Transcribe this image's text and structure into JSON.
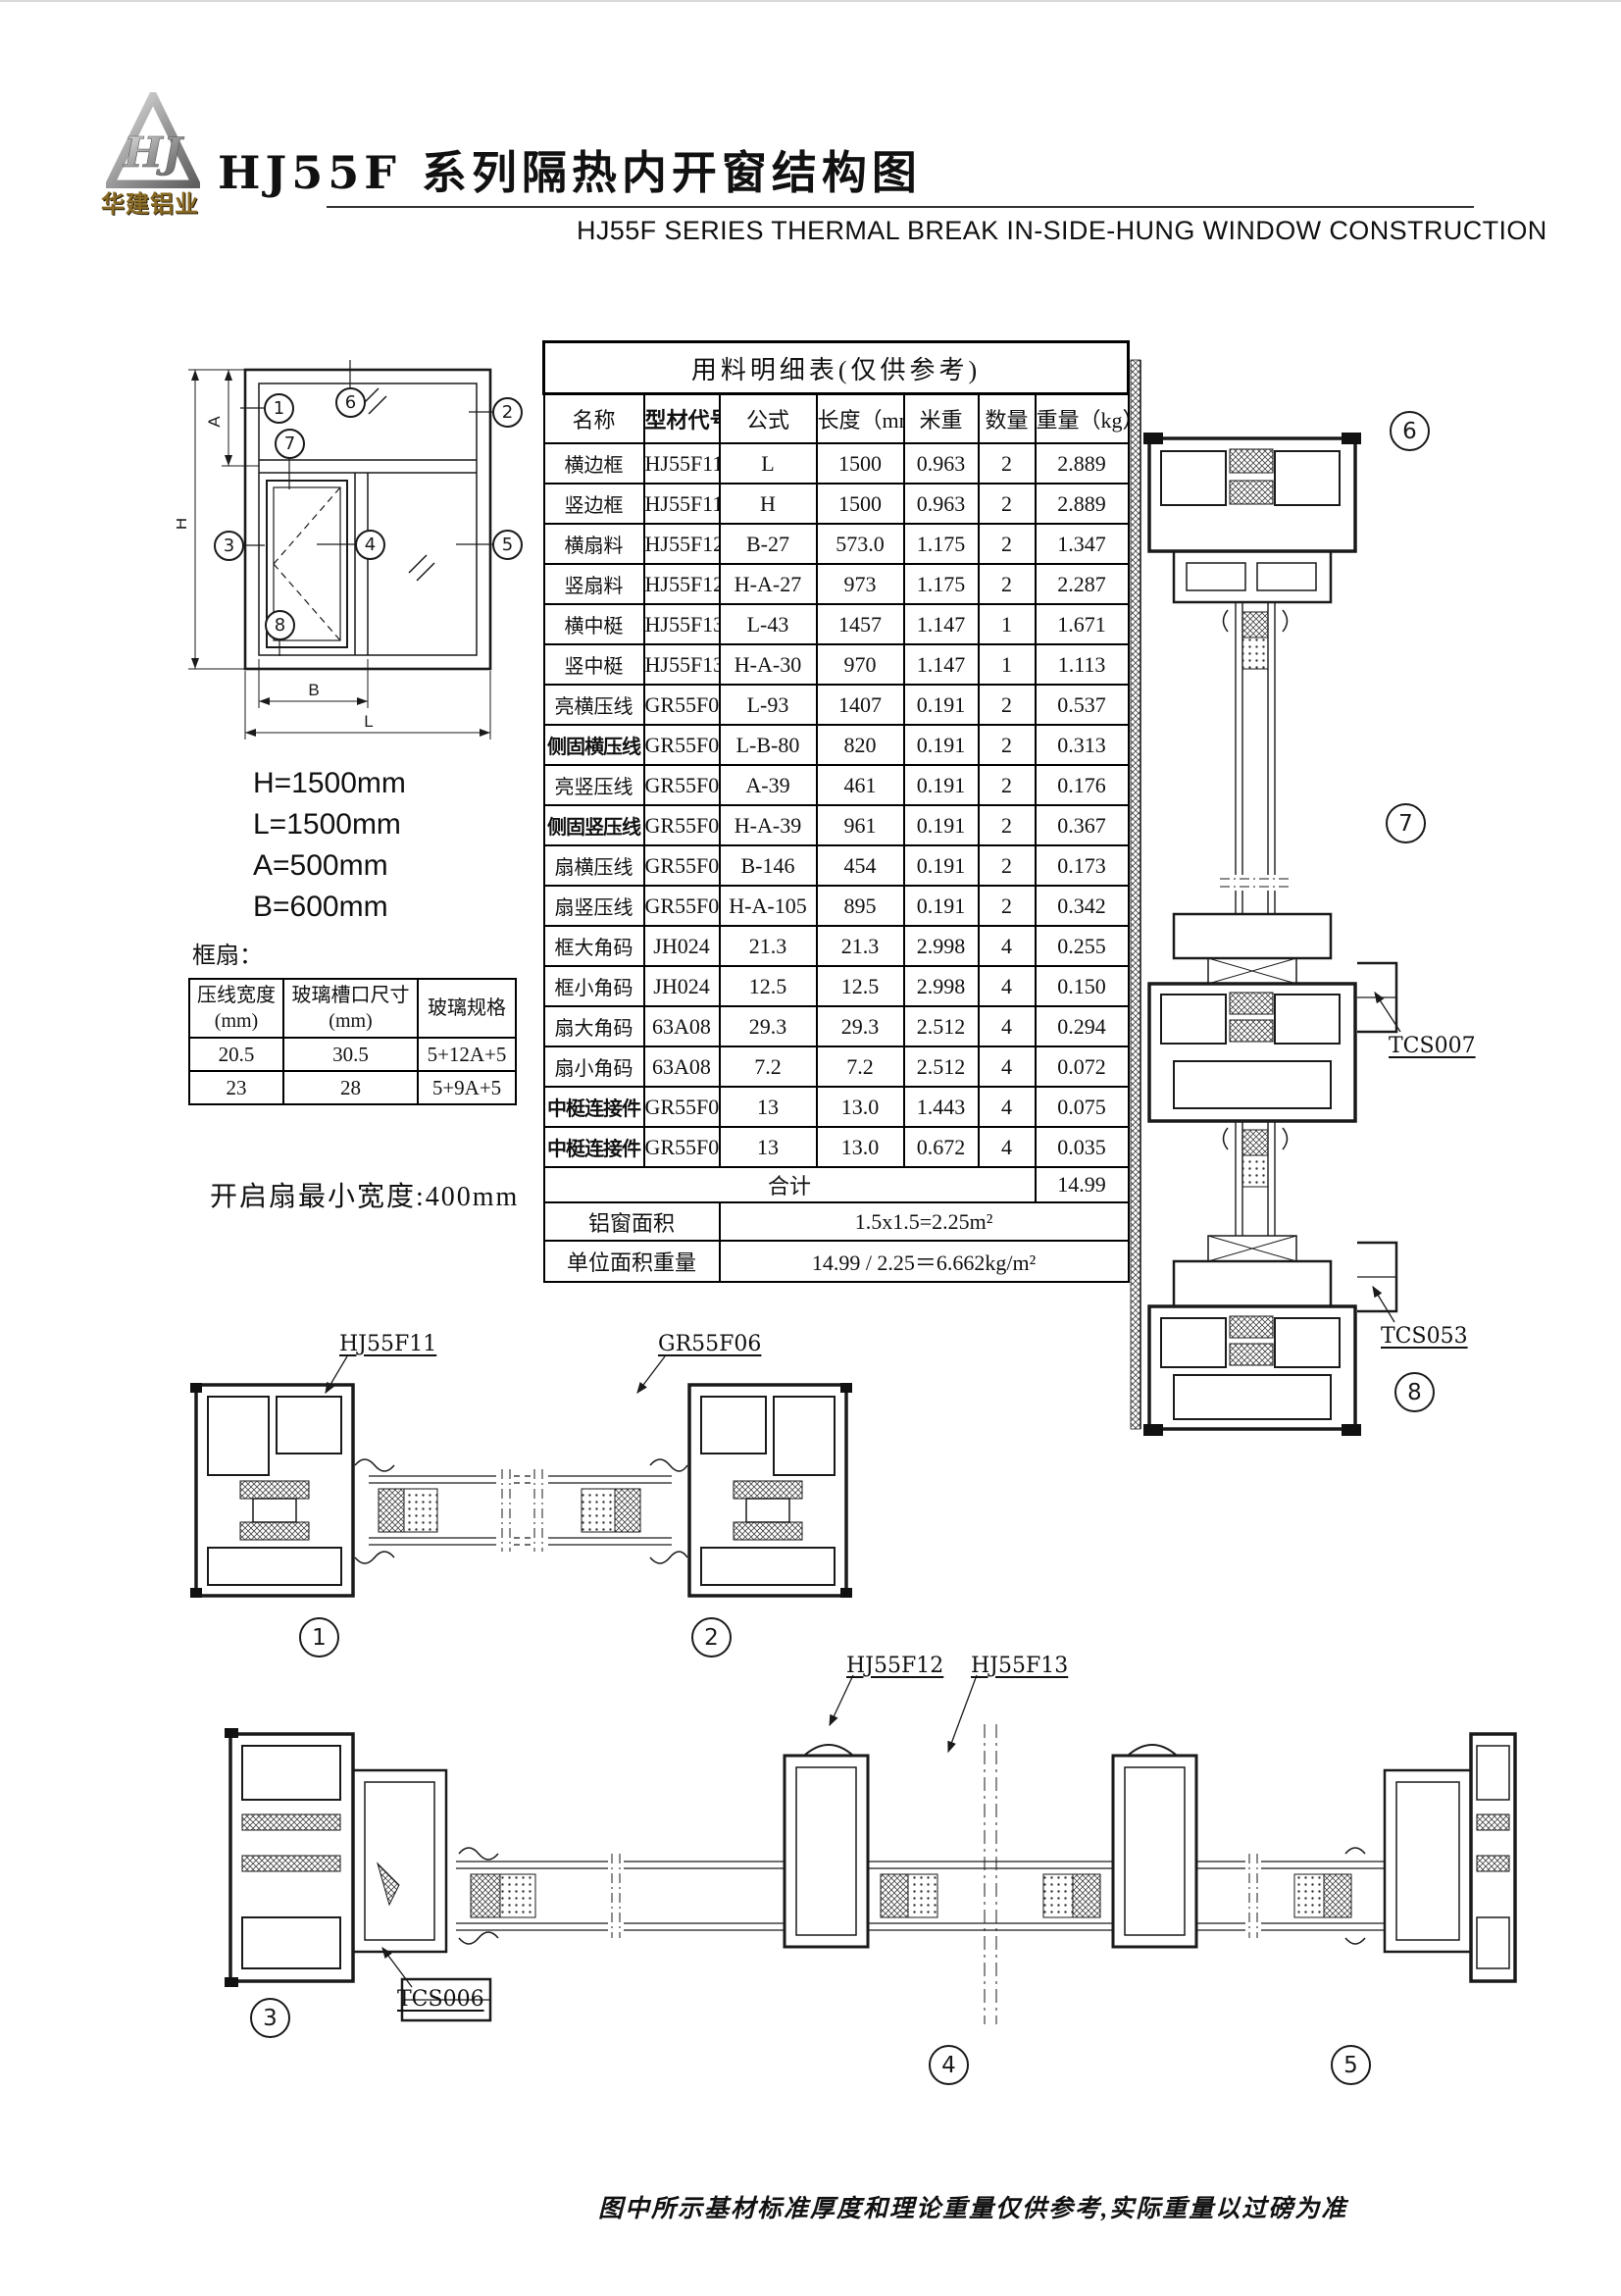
{
  "header": {
    "logo_monogram": "HJ",
    "logo_text": "华建铝业",
    "title": "HJ55F 系列隔热内开窗结构图",
    "subtitle": "HJ55F SERIES THERMAL BREAK IN-SIDE-HUNG WINDOW CONSTRUCTION"
  },
  "elevation": {
    "dims": {
      "h": "H",
      "a": "A",
      "b": "B",
      "l": "L"
    },
    "dim_values": [
      "H=1500mm",
      "L=1500mm",
      "A=500mm",
      "B=600mm"
    ]
  },
  "callouts": {
    "c1": "1",
    "c2": "2",
    "c3": "3",
    "c4": "4",
    "c5": "5",
    "c6": "6",
    "c7": "7",
    "c8": "8"
  },
  "materials_table": {
    "title": "用料明细表(仅供参考)",
    "columns": [
      "名称",
      "型材代号",
      "公式",
      "长度（mm）",
      "米重",
      "数量",
      "重量（kg）"
    ],
    "rows": [
      {
        "name": "横边框",
        "code": "HJ55F11",
        "formula": "L",
        "length": "1500",
        "meter_weight": "0.963",
        "qty": "2",
        "weight": "2.889"
      },
      {
        "name": "竖边框",
        "code": "HJ55F11",
        "formula": "H",
        "length": "1500",
        "meter_weight": "0.963",
        "qty": "2",
        "weight": "2.889"
      },
      {
        "name": "横扇料",
        "code": "HJ55F12",
        "formula": "B-27",
        "length": "573.0",
        "meter_weight": "1.175",
        "qty": "2",
        "weight": "1.347"
      },
      {
        "name": "竖扇料",
        "code": "HJ55F12",
        "formula": "H-A-27",
        "length": "973",
        "meter_weight": "1.175",
        "qty": "2",
        "weight": "2.287"
      },
      {
        "name": "横中梃",
        "code": "HJ55F13",
        "formula": "L-43",
        "length": "1457",
        "meter_weight": "1.147",
        "qty": "1",
        "weight": "1.671"
      },
      {
        "name": "竖中梃",
        "code": "HJ55F13",
        "formula": "H-A-30",
        "length": "970",
        "meter_weight": "1.147",
        "qty": "1",
        "weight": "1.113"
      },
      {
        "name": "亮横压线",
        "code": "GR55F06",
        "formula": "L-93",
        "length": "1407",
        "meter_weight": "0.191",
        "qty": "2",
        "weight": "0.537"
      },
      {
        "name": "侧固横压线",
        "code": "GR55F06",
        "formula": "L-B-80",
        "length": "820",
        "meter_weight": "0.191",
        "qty": "2",
        "weight": "0.313"
      },
      {
        "name": "亮竖压线",
        "code": "GR55F06",
        "formula": "A-39",
        "length": "461",
        "meter_weight": "0.191",
        "qty": "2",
        "weight": "0.176"
      },
      {
        "name": "侧固竖压线",
        "code": "GR55F06",
        "formula": "H-A-39",
        "length": "961",
        "meter_weight": "0.191",
        "qty": "2",
        "weight": "0.367"
      },
      {
        "name": "扇横压线",
        "code": "GR55F06",
        "formula": "B-146",
        "length": "454",
        "meter_weight": "0.191",
        "qty": "2",
        "weight": "0.173"
      },
      {
        "name": "扇竖压线",
        "code": "GR55F06",
        "formula": "H-A-105",
        "length": "895",
        "meter_weight": "0.191",
        "qty": "2",
        "weight": "0.342"
      },
      {
        "name": "框大角码",
        "code": "JH024",
        "formula": "21.3",
        "length": "21.3",
        "meter_weight": "2.998",
        "qty": "4",
        "weight": "0.255"
      },
      {
        "name": "框小角码",
        "code": "JH024",
        "formula": "12.5",
        "length": "12.5",
        "meter_weight": "2.998",
        "qty": "4",
        "weight": "0.150"
      },
      {
        "name": "扇大角码",
        "code": "63A08",
        "formula": "29.3",
        "length": "29.3",
        "meter_weight": "2.512",
        "qty": "4",
        "weight": "0.294"
      },
      {
        "name": "扇小角码",
        "code": "63A08",
        "formula": "7.2",
        "length": "7.2",
        "meter_weight": "2.512",
        "qty": "4",
        "weight": "0.072"
      },
      {
        "name": "中梃连接件",
        "code": "GR55F08",
        "formula": "13",
        "length": "13.0",
        "meter_weight": "1.443",
        "qty": "4",
        "weight": "0.075"
      },
      {
        "name": "中梃连接件",
        "code": "GR55F09",
        "formula": "13",
        "length": "13.0",
        "meter_weight": "0.672",
        "qty": "4",
        "weight": "0.035"
      }
    ],
    "total_label": "合计",
    "total_value": "14.99",
    "area_label": "铝窗面积",
    "area_value": "1.5x1.5=2.25m²",
    "unit_label": "单位面积重量",
    "unit_value": "14.99 / 2.25＝6.662kg/m²"
  },
  "frame_sash_table": {
    "label": "框扇：",
    "col1": "压线宽度",
    "col1_unit": "(mm)",
    "col2": "玻璃槽口尺寸",
    "col2_unit": "(mm)",
    "col3": "玻璃规格",
    "rows": [
      [
        "20.5",
        "30.5",
        "5+12A+5"
      ],
      [
        "23",
        "28",
        "5+9A+5"
      ]
    ]
  },
  "notes": {
    "min_width": "开启扇最小宽度:400mm",
    "footer": "图中所示基材标准厚度和理论重量仅供参考,实际重量以过磅为准"
  },
  "profile_labels": {
    "p_hj55f11": "HJ55F11",
    "p_gr55f06": "GR55F06",
    "p_hj55f12": "HJ55F12",
    "p_hj55f13": "HJ55F13",
    "p_tcs006": "TCS006",
    "p_tcs007": "TCS007",
    "p_tcs053": "TCS053"
  }
}
